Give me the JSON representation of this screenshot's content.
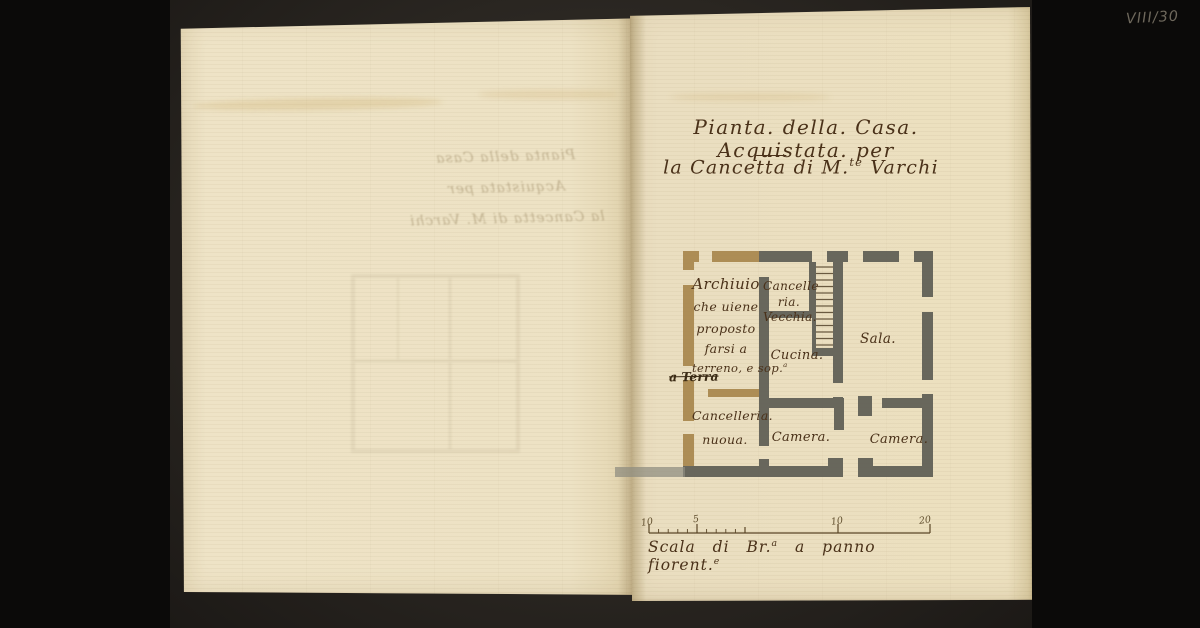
{
  "annotations": {
    "shelfmark": "VIII/30"
  },
  "title": {
    "line1": "Pianta. della. Casa. Acquistata. per",
    "line2_p1": "la Cance",
    "line2_p2": "tta",
    "line2_p3": " di M.",
    "line2_sup": "te",
    "line2_p5": " Varchi"
  },
  "plan": {
    "rooms": {
      "archivio": {
        "l1": "Archiuio",
        "l2": "che uiene",
        "l3": "proposto",
        "l4": "farsi a",
        "l5_pre": "terreno, e sop.",
        "l5_sup": "a"
      },
      "terra": "a Terra",
      "cancelleria_vecchia": {
        "l1": "Cancelle",
        "l2": "ria.",
        "l3": "Vecchia."
      },
      "cucina": "Cucina.",
      "sala": "Sala.",
      "cancelleria_nuova": {
        "l1": "Cancelleria.",
        "l2": "nuoua."
      },
      "camera_mid": "Camera.",
      "camera_right": "Camera."
    }
  },
  "scale_bar": {
    "ticks": [
      "10",
      "5",
      "10",
      "20"
    ],
    "caption_p1": "Scala di Br.",
    "caption_sup1": "a",
    "caption_p2": " a panno fiorent.",
    "caption_sup2": "e"
  },
  "bleedthrough": {
    "line1": "Pianta della Casa Acquistata per",
    "line2": "la Cancetta di M. Varchi"
  },
  "colors": {
    "ink": "#4a3119",
    "wall_gray": "#5f5e55",
    "wall_tan": "#aa8950",
    "paper": "#ece1c2",
    "pencil": "#6e685c"
  }
}
